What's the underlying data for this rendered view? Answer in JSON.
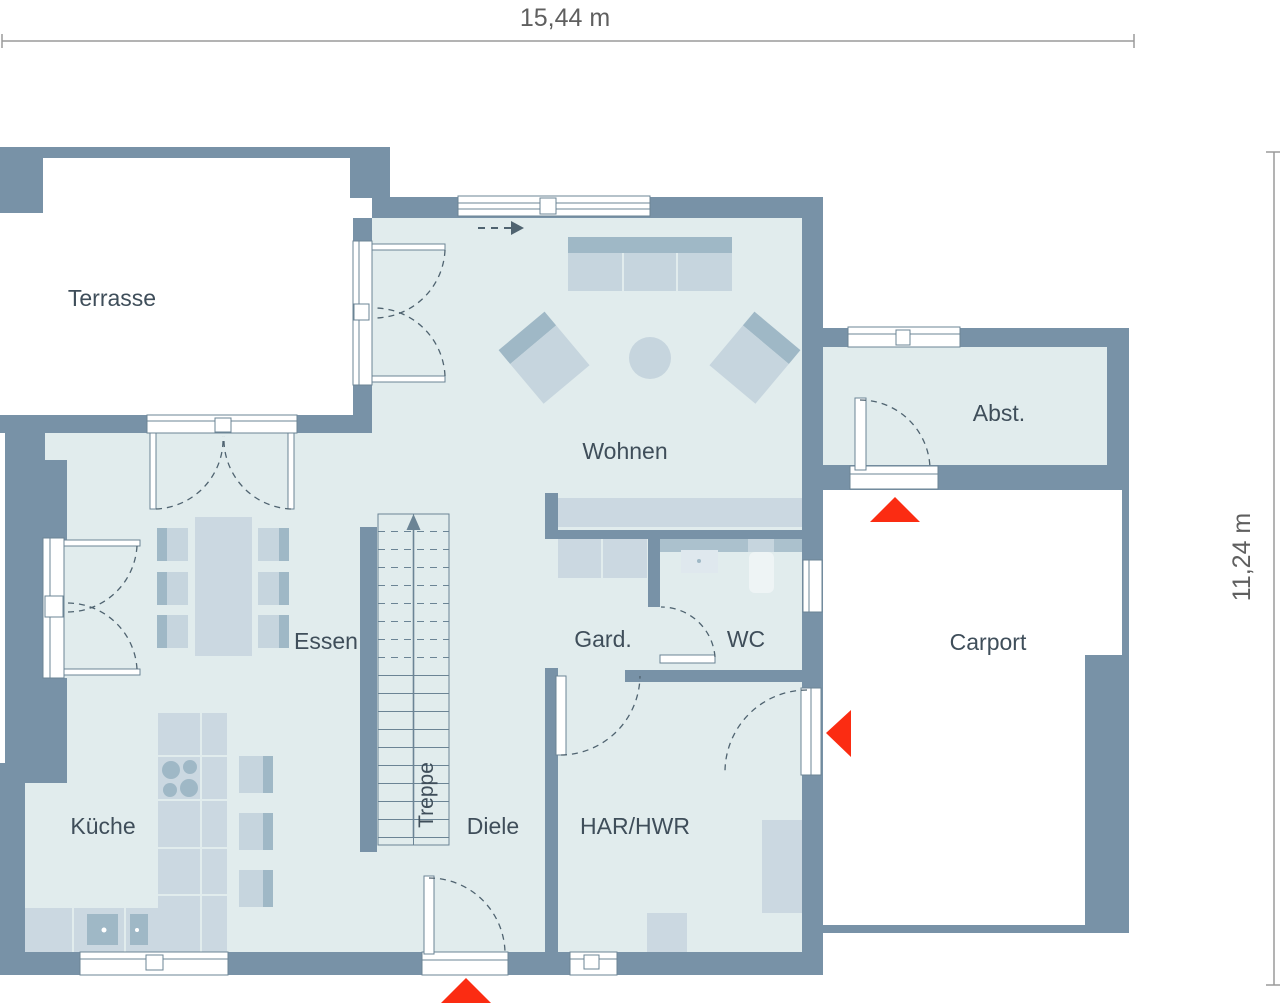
{
  "title": "Floor plan ground floor",
  "dimensions": {
    "width_label": "15,44 m",
    "height_label": "11,24 m"
  },
  "rooms": {
    "terrasse": {
      "label": "Terrasse"
    },
    "wohnen": {
      "label": "Wohnen"
    },
    "essen": {
      "label": "Essen"
    },
    "kueche": {
      "label": "Küche"
    },
    "treppe": {
      "label": "Treppe"
    },
    "diele": {
      "label": "Diele"
    },
    "garderobe": {
      "label": "Gard."
    },
    "wc": {
      "label": "WC"
    },
    "har_hwr": {
      "label": "HAR/HWR"
    },
    "abstellraum": {
      "label": "Abst."
    },
    "carport": {
      "label": "Carport"
    }
  },
  "entrance_markers": {
    "count": 3,
    "color": "#fb2c12"
  },
  "colors": {
    "wall": "#7892a7",
    "floor": "#e1eced",
    "furniture": "#c6d5de",
    "furniture_dark": "#9fb8c6",
    "outline": "#6b8495",
    "door_swing": "#4f6370",
    "label_text": "#3f4e5a",
    "dimension_text": "#5f5f5f",
    "outside": "#ffffff"
  }
}
